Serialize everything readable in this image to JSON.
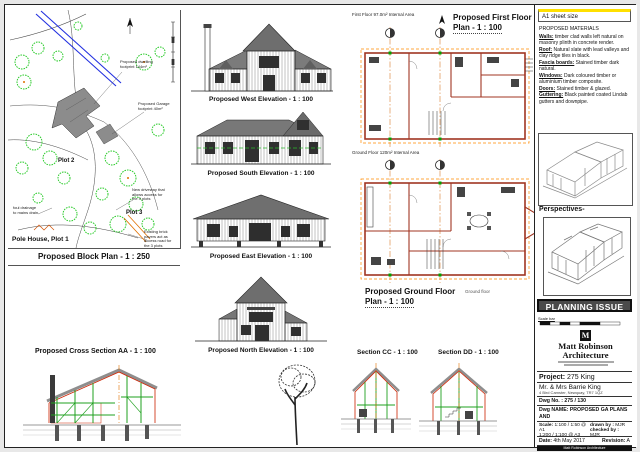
{
  "block_plan": {
    "title": "Proposed Block Plan - 1 : 250",
    "plot1_label": "Pole House, Plot 1",
    "plot2_label": "Plot 2",
    "plot3_label": "Plot 3",
    "ann_dwelling": "Proposed dwelling footprint 144m²",
    "ann_garage": "Proposed Garage footprint 40m²",
    "ann_drainage": "foul drainage to mains drain",
    "ann_pavers": "Existing brick pavers act as access road for the 3 plots",
    "ann_driveway": "New driveway that allows access for the 3 plots"
  },
  "elevations": [
    {
      "title": "Proposed West Elevation - 1 : 100"
    },
    {
      "title": "Proposed South Elevation - 1 : 100"
    },
    {
      "title": "Proposed East Elevation - 1 : 100"
    },
    {
      "title": "Proposed North Elevation - 1 : 100"
    }
  ],
  "plans": {
    "first": {
      "area_note": "First Floor 97.0m² Internal Area",
      "title_l1": "Proposed First Floor",
      "title_l2": "Plan - 1 : 100"
    },
    "ground": {
      "area_note": "Ground Floor 120m² Internal Area",
      "title_l1": "Proposed Ground Floor",
      "title_l2": "Plan - 1 : 100",
      "floor_note": "Ground floor"
    }
  },
  "sections": {
    "aa_title": "Proposed Cross Section AA - 1 : 100",
    "cc_title": "Section CC - 1 : 100",
    "dd_title": "Section DD - 1 : 100"
  },
  "right_panel": {
    "sheet_size": "A1 sheet size",
    "materials_heading": "PROPOSED MATERIALS",
    "materials": [
      {
        "key": "Walls:",
        "text": " timber clad walls left natural on masonry plinth in concrete render."
      },
      {
        "key": "Roof:",
        "text": " Natural slate with lead valleys and clay ridge tiles in black."
      },
      {
        "key": "Fascia boards:",
        "text": " Stained timber dark natural."
      },
      {
        "key": "Windows:",
        "text": " Dark coloured timber or aluminium timber composite."
      },
      {
        "key": "Doors:",
        "text": " Stained timber & glazed."
      },
      {
        "key": "Guttering:",
        "text": " Black painted coated Lindab gutters and downpipe."
      }
    ],
    "perspectives_label": "Perspectives-",
    "planning_issue": "PLANNING ISSUE",
    "scale_bar_note": "Scale bar",
    "firm_name_l1": "Matt Robinson",
    "firm_name_l2": "Architecture",
    "firm_initial": "M",
    "firm_footer": "Matt Robinson Architecture"
  },
  "title_block": {
    "project_label": "Project:",
    "project_value": " 275 King",
    "client": "Mr. & Mrs Barrie King",
    "client_address": "4 Bird Camster, Newquay, TR7 1QZ",
    "dwg_no_label": "Dwg No. :",
    "dwg_no_value": " 275 / 130",
    "dwg_name_label": "Dwg NAME:",
    "dwg_name_l1": " PROPOSED  GA PLANS AND",
    "dwg_name_l2": "SECTIONS--Plot 2, Meadow Land TR27 9GY",
    "scale_label": "Scale:",
    "scale_a1": " 1:100 / 1:50 @ A1",
    "scale_a3": "1:200 / 1:100 @ A3",
    "drawn_label": "drawn by :",
    "drawn_value": " MJR",
    "checked_label": "checked by :",
    "checked_value": " MJR",
    "date_label": "Date:",
    "date_value": " 4th May 2017",
    "revision_label": "Revision:",
    "revision_value": " A"
  }
}
